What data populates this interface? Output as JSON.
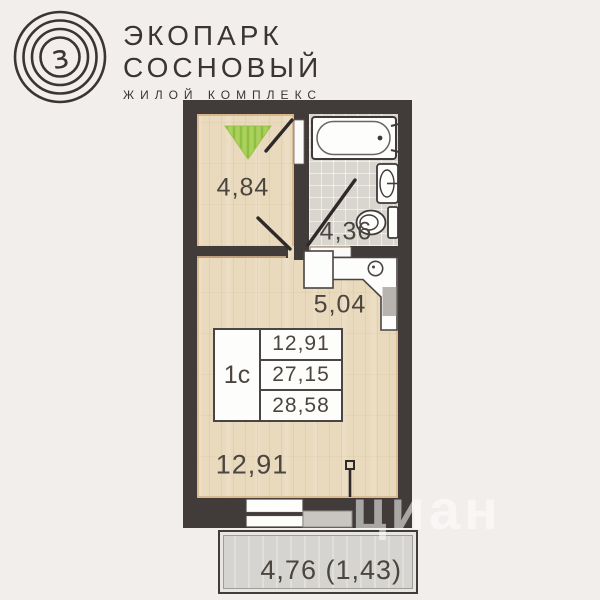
{
  "logo": {
    "mark_letter": "з",
    "title_line1": "ЭКОПАРК",
    "title_line2": "СОСНОВЫЙ",
    "subtitle": "ЖИЛОЙ КОМПЛЕКС"
  },
  "plan": {
    "rooms": [
      {
        "name": "room-top-left",
        "area": "4,84"
      },
      {
        "name": "bathroom",
        "area": "4,36"
      },
      {
        "name": "hall-kitchen",
        "area": "5,04"
      },
      {
        "name": "living-room",
        "area": "12,91"
      }
    ],
    "info_table": {
      "type_label": "1с",
      "rows": [
        "12,91",
        "27,15",
        "28,58"
      ]
    },
    "balcony_label": "4,76 (1,43)",
    "colors": {
      "background": "#f2eeeb",
      "walls": "#413b3a",
      "wood_floor": "#e9dabd",
      "tile_floor": "#d9d6cf",
      "balcony_floor": "#d6d4d0",
      "accent_green": "#abd05b",
      "trim": "#d8b489",
      "label_text": "#4b4540"
    }
  },
  "watermark": {
    "text": "циан"
  }
}
